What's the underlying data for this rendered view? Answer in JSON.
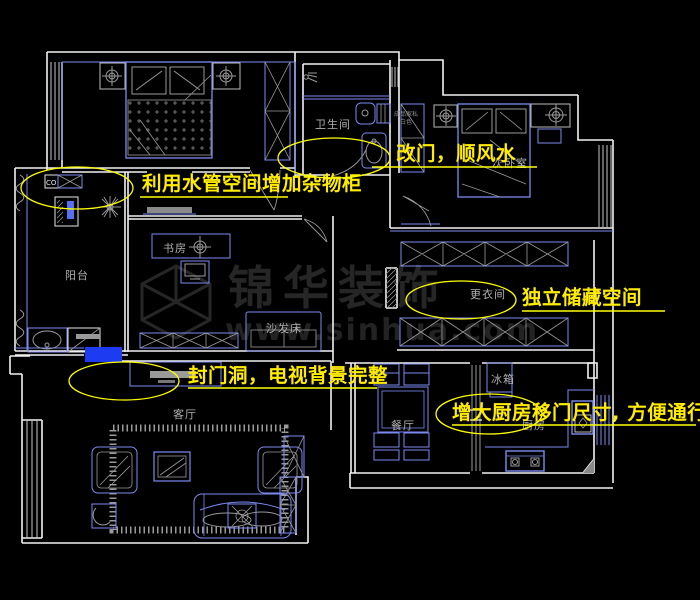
{
  "canvas": {
    "width": 700,
    "height": 600,
    "background": "#000000"
  },
  "colors": {
    "wall_white": "#f2f2f2",
    "furniture_blue": "#7b8bf2",
    "detail_gray": "#9a9a9a",
    "window_gray": "#c8c8c8",
    "annotation_yellow": "#ffff00",
    "annotation_text_yellow": "#ffec00",
    "label_gray": "#b0b0b0",
    "sealed_fill_blue": "#1d3cf2",
    "watermark_gray": "#262626",
    "background": "#000000"
  },
  "watermark": {
    "brand": "锦华装饰",
    "url": "www.sinhua.com"
  },
  "room_labels": {
    "bathroom": "卫生间",
    "secondary_bedroom": "次卧室",
    "dressing_room": "更衣间",
    "study": "书房",
    "balcony": "阳台",
    "sofa_bed": "沙发床",
    "living_room": "客厅",
    "dining_room": "餐厅",
    "kitchen": "厨房",
    "fridge": "冰箱",
    "heater_marks": "CO"
  },
  "closet_note": {
    "line1": "成品家私",
    "line2": "白色"
  },
  "annotations": {
    "pipe_cabinet": "利用水管空间增加杂物柜",
    "door_fengshui": "改门，顺风水",
    "storage": "独立储藏空间",
    "sealed_door": "封门洞，电视背景完整",
    "kitchen_door": "增大厨房移门尺寸, 方便通行"
  }
}
